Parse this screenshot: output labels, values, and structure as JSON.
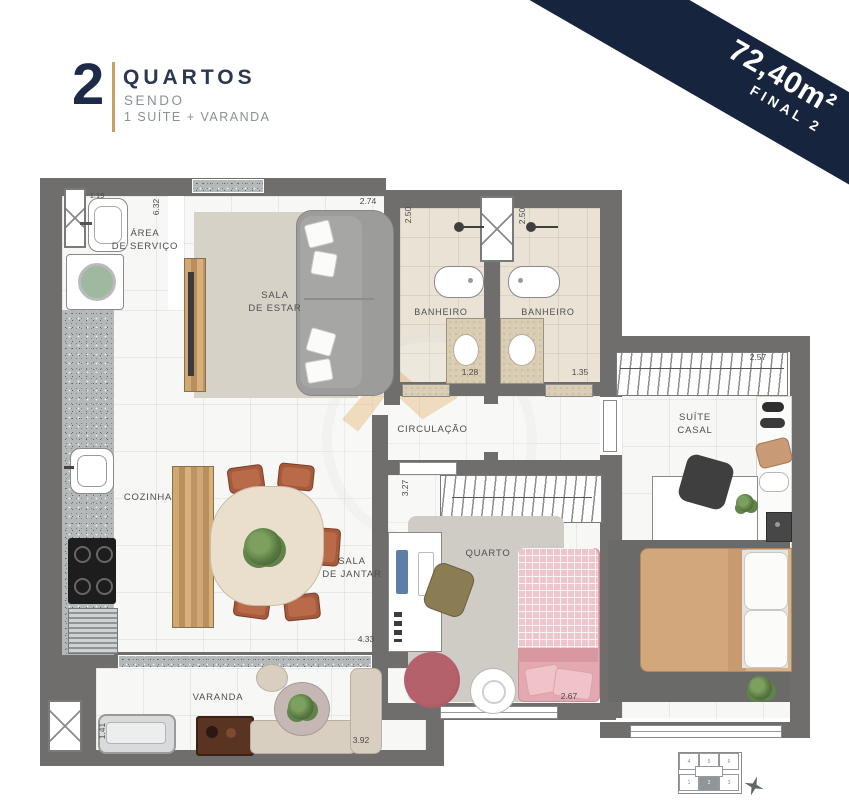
{
  "header": {
    "number": "2",
    "title": "QUARTOS",
    "line2": "SENDO",
    "line3": "1 SUÍTE + VARANDA",
    "accent_color": "#c99f63",
    "text_color": "#1d2b49"
  },
  "ribbon": {
    "area": "72,40m²",
    "unit": "FINAL 2",
    "bg_color": "#16243d"
  },
  "rooms": {
    "area_servico": {
      "label": "ÁREA\nDE SERVIÇO"
    },
    "sala_estar": {
      "label": "SALA\nDE ESTAR"
    },
    "banheiro1": {
      "label": "BANHEIRO"
    },
    "banheiro2": {
      "label": "BANHEIRO"
    },
    "circulacao": {
      "label": "CIRCULAÇÃO"
    },
    "suite_casal": {
      "label": "SUÍTE\nCASAL"
    },
    "cozinha": {
      "label": "COZINHA"
    },
    "sala_jantar": {
      "label": "SALA\nDE JANTAR"
    },
    "quarto": {
      "label": "QUARTO"
    },
    "varanda": {
      "label": "VARANDA"
    }
  },
  "dimensions": {
    "servico_width": "1.19",
    "servico_depth": "6.32",
    "sala_width": "2.74",
    "banheiro1_depth": "2.50",
    "banheiro2_depth": "2.50",
    "banheiro1_width": "1.28",
    "banheiro2_width": "1.35",
    "suite_width": "2.57",
    "quarto_depth": "3.27",
    "jantar_width": "4.33",
    "quarto_width": "2.67",
    "varanda_width": "3.92",
    "varanda_depth": "1.41"
  },
  "keyplan": {
    "units": [
      "4",
      "5",
      "6",
      "1",
      "2",
      "3"
    ],
    "highlighted_unit": "2"
  },
  "colors": {
    "wall": "#6f6e6c",
    "bath_floor": "#eae3d5",
    "navy": "#16243d",
    "wood": "#c6a06c"
  }
}
